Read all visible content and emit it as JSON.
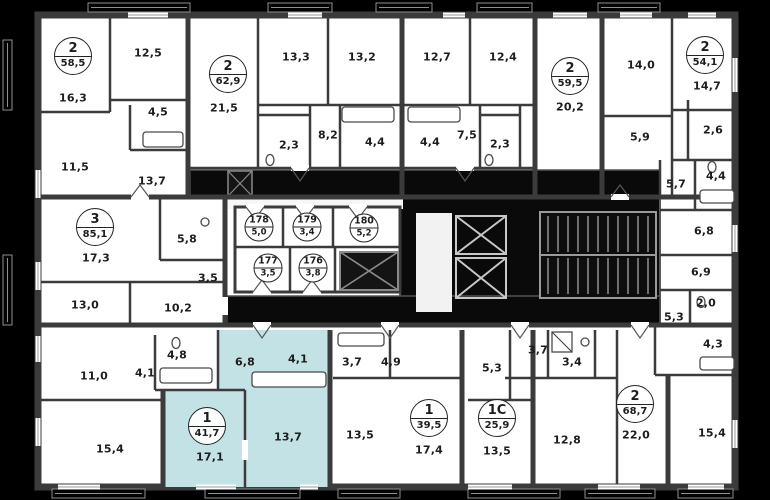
{
  "colors": {
    "background": "#000000",
    "wall": "#3b3b3b",
    "floor": "#ffffff",
    "highlight": "#c3e2e5",
    "core": "#0a0a0a",
    "label": "#1d1d1d"
  },
  "apartments": [
    {
      "number": "2",
      "area": "58,5",
      "x": 73,
      "y": 56,
      "highlighted": false
    },
    {
      "number": "2",
      "area": "62,9",
      "x": 228,
      "y": 74,
      "highlighted": false
    },
    {
      "number": "2",
      "area": "59,5",
      "x": 570,
      "y": 76,
      "highlighted": false
    },
    {
      "number": "2",
      "area": "54,1",
      "x": 705,
      "y": 55,
      "highlighted": false
    },
    {
      "number": "3",
      "area": "85,1",
      "x": 95,
      "y": 227,
      "highlighted": false
    },
    {
      "number": "1",
      "area": "41,7",
      "x": 207,
      "y": 426,
      "highlighted": true
    },
    {
      "number": "1",
      "area": "39,5",
      "x": 429,
      "y": 418,
      "highlighted": false
    },
    {
      "number": "1C",
      "area": "25,9",
      "x": 497,
      "y": 418,
      "highlighted": false
    },
    {
      "number": "2",
      "area": "68,7",
      "x": 635,
      "y": 404,
      "highlighted": false
    }
  ],
  "storerooms": [
    {
      "number": "178",
      "area": "5,0",
      "x": 259,
      "y": 227
    },
    {
      "number": "179",
      "area": "3,4",
      "x": 307,
      "y": 227
    },
    {
      "number": "180",
      "area": "5,2",
      "x": 364,
      "y": 228
    },
    {
      "number": "177",
      "area": "3,5",
      "x": 268,
      "y": 268
    },
    {
      "number": "176",
      "area": "3,8",
      "x": 313,
      "y": 268
    }
  ],
  "rooms": [
    {
      "area": "16,3",
      "x": 73,
      "y": 98,
      "highlighted": false
    },
    {
      "area": "12,5",
      "x": 148,
      "y": 53,
      "highlighted": false
    },
    {
      "area": "4,5",
      "x": 158,
      "y": 112,
      "highlighted": false
    },
    {
      "area": "11,5",
      "x": 75,
      "y": 167,
      "highlighted": false
    },
    {
      "area": "13,7",
      "x": 152,
      "y": 181,
      "highlighted": false
    },
    {
      "area": "21,5",
      "x": 224,
      "y": 108,
      "highlighted": false
    },
    {
      "area": "13,3",
      "x": 296,
      "y": 57,
      "highlighted": false
    },
    {
      "area": "13,2",
      "x": 362,
      "y": 57,
      "highlighted": false
    },
    {
      "area": "2,3",
      "x": 289,
      "y": 145,
      "highlighted": false
    },
    {
      "area": "8,2",
      "x": 328,
      "y": 135,
      "highlighted": false
    },
    {
      "area": "4,4",
      "x": 375,
      "y": 142,
      "highlighted": false
    },
    {
      "area": "4,4",
      "x": 430,
      "y": 142,
      "highlighted": false
    },
    {
      "area": "12,7",
      "x": 437,
      "y": 57,
      "highlighted": false
    },
    {
      "area": "12,4",
      "x": 503,
      "y": 57,
      "highlighted": false
    },
    {
      "area": "7,5",
      "x": 467,
      "y": 135,
      "highlighted": false
    },
    {
      "area": "2,3",
      "x": 500,
      "y": 144,
      "highlighted": false
    },
    {
      "area": "20,2",
      "x": 570,
      "y": 107,
      "highlighted": false
    },
    {
      "area": "14,0",
      "x": 641,
      "y": 65,
      "highlighted": false
    },
    {
      "area": "14,7",
      "x": 707,
      "y": 86,
      "highlighted": false
    },
    {
      "area": "5,9",
      "x": 640,
      "y": 137,
      "highlighted": false
    },
    {
      "area": "2,6",
      "x": 713,
      "y": 130,
      "highlighted": false
    },
    {
      "area": "5,7",
      "x": 676,
      "y": 184,
      "highlighted": false
    },
    {
      "area": "4,4",
      "x": 716,
      "y": 176,
      "highlighted": false
    },
    {
      "area": "6,8",
      "x": 704,
      "y": 231,
      "highlighted": false
    },
    {
      "area": "6,9",
      "x": 701,
      "y": 272,
      "highlighted": false
    },
    {
      "area": "2,0",
      "x": 706,
      "y": 303,
      "highlighted": false
    },
    {
      "area": "5,3",
      "x": 674,
      "y": 317,
      "highlighted": false
    },
    {
      "area": "4,3",
      "x": 713,
      "y": 344,
      "highlighted": false
    },
    {
      "area": "17,3",
      "x": 96,
      "y": 258,
      "highlighted": false
    },
    {
      "area": "5,8",
      "x": 187,
      "y": 239,
      "highlighted": false
    },
    {
      "area": "3,5",
      "x": 208,
      "y": 278,
      "highlighted": false
    },
    {
      "area": "13,0",
      "x": 85,
      "y": 305,
      "highlighted": false
    },
    {
      "area": "10,2",
      "x": 178,
      "y": 308,
      "highlighted": false
    },
    {
      "area": "4,8",
      "x": 177,
      "y": 355,
      "highlighted": false
    },
    {
      "area": "4,1",
      "x": 145,
      "y": 373,
      "highlighted": false
    },
    {
      "area": "11,0",
      "x": 94,
      "y": 376,
      "highlighted": false
    },
    {
      "area": "15,4",
      "x": 110,
      "y": 449,
      "highlighted": false
    },
    {
      "area": "6,8",
      "x": 245,
      "y": 362,
      "highlighted": true
    },
    {
      "area": "4,1",
      "x": 298,
      "y": 359,
      "highlighted": true
    },
    {
      "area": "17,1",
      "x": 210,
      "y": 457,
      "highlighted": true
    },
    {
      "area": "13,7",
      "x": 288,
      "y": 437,
      "highlighted": true
    },
    {
      "area": "3,7",
      "x": 352,
      "y": 362,
      "highlighted": false
    },
    {
      "area": "4,9",
      "x": 391,
      "y": 362,
      "highlighted": false
    },
    {
      "area": "13,5",
      "x": 360,
      "y": 435,
      "highlighted": false
    },
    {
      "area": "17,4",
      "x": 429,
      "y": 450,
      "highlighted": false
    },
    {
      "area": "5,3",
      "x": 492,
      "y": 368,
      "highlighted": false
    },
    {
      "area": "3,7",
      "x": 538,
      "y": 350,
      "highlighted": false
    },
    {
      "area": "3,4",
      "x": 572,
      "y": 362,
      "highlighted": false
    },
    {
      "area": "13,5",
      "x": 497,
      "y": 451,
      "highlighted": false
    },
    {
      "area": "12,8",
      "x": 567,
      "y": 440,
      "highlighted": false
    },
    {
      "area": "22,0",
      "x": 636,
      "y": 435,
      "highlighted": false
    },
    {
      "area": "15,4",
      "x": 712,
      "y": 433,
      "highlighted": false
    }
  ]
}
